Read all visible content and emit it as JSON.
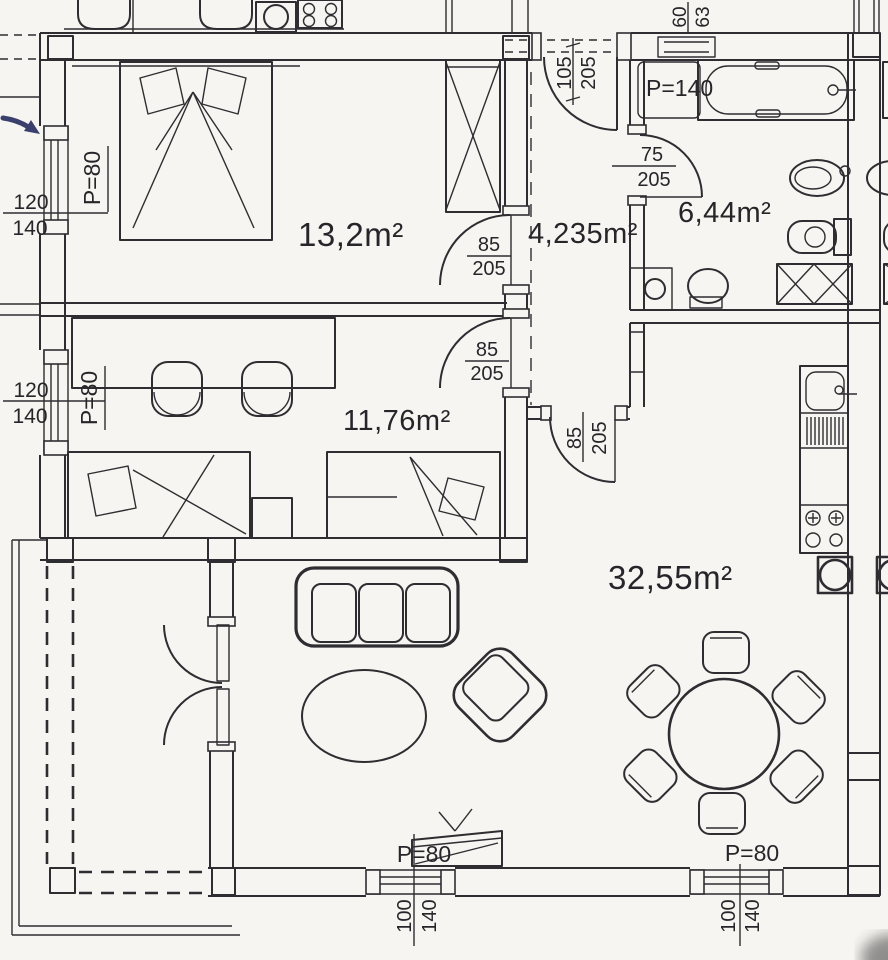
{
  "colors": {
    "ink": "#2e2d31",
    "paper": "#f6f5f1",
    "arrow_accent": "#3b3f6e"
  },
  "rooms": {
    "bedroom_main": {
      "area": "13,2m²"
    },
    "hallway": {
      "area": "4,235m²"
    },
    "bathroom": {
      "area": "6,44m²"
    },
    "bedroom_small": {
      "area": "11,76m²"
    },
    "living_room": {
      "area": "32,55m²"
    }
  },
  "openings": {
    "entry_door": {
      "w": "105",
      "h": "205"
    },
    "bathroom_door": {
      "w": "75",
      "h": "205"
    },
    "bedroom_main_door": {
      "w": "85",
      "h": "205"
    },
    "bedroom_small_door": {
      "w": "85",
      "h": "205"
    },
    "living_door": {
      "w": "85",
      "h": "205"
    },
    "bath_window": {
      "w": "60",
      "h": "63"
    },
    "window_left_upper": {
      "w": "120",
      "h": "140"
    },
    "window_left_lower": {
      "w": "120",
      "h": "140"
    },
    "window_bottom_left": {
      "w": "100",
      "h": "140"
    },
    "window_bottom_right": {
      "w": "100",
      "h": "140"
    }
  },
  "parapets": {
    "window_left_upper": "P=80",
    "window_left_lower": "P=80",
    "window_bottom_left": "P=80",
    "window_bottom_right": "P=80",
    "bath_window": "P=140"
  }
}
